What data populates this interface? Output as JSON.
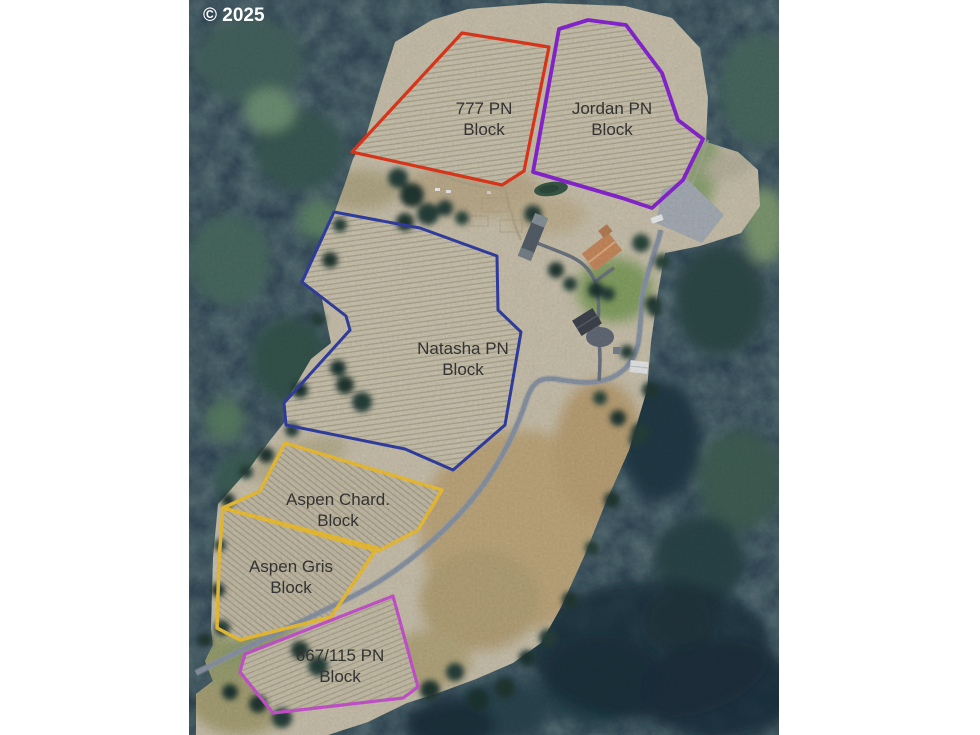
{
  "copyright": "© 2025",
  "map": {
    "type": "aerial-vineyard-property-map",
    "background_color": "#FFFFFF",
    "forest_color": "#2A4050",
    "field_color": "#C9C1AC",
    "vineyard_fill": "#CDC6B2",
    "road_color": "#8C96A6",
    "label_text_color": "#333333",
    "copyright_color": "#FFFFFF"
  },
  "blocks": [
    {
      "id": "777-pn",
      "label_line1": "777 PN",
      "label_line2": "Block",
      "outline_color": "#E8391D"
    },
    {
      "id": "jordan-pn",
      "label_line1": "Jordan PN",
      "label_line2": "Block",
      "outline_color": "#8B26D8"
    },
    {
      "id": "natasha-pn",
      "label_line1": "Natasha PN",
      "label_line2": "Block",
      "outline_color": "#3340A8"
    },
    {
      "id": "aspen-chard",
      "label_line1": "Aspen Chard.",
      "label_line2": "Block",
      "outline_color": "#F2C338"
    },
    {
      "id": "aspen-gris",
      "label_line1": "Aspen Gris",
      "label_line2": "Block",
      "outline_color": "#F2C338"
    },
    {
      "id": "667-115-pn",
      "label_line1": "667/115 PN",
      "label_line2": "Block",
      "outline_color": "#CC55D4"
    }
  ]
}
